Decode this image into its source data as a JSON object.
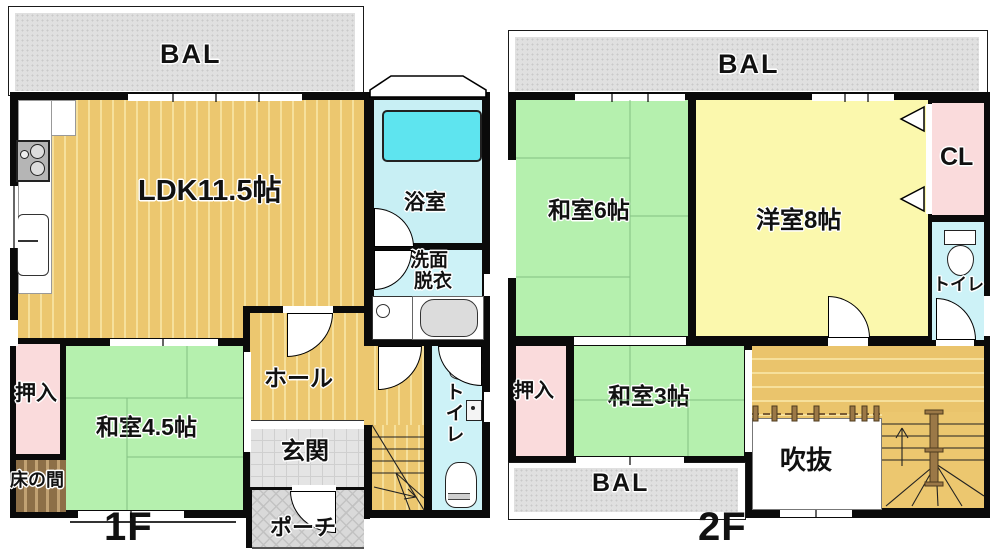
{
  "palette": {
    "wall": "#0a0a0a",
    "wood_floor": "#ecc76f",
    "wood_stripe": "#f6e09c",
    "tatami_green": "#b5f0ae",
    "western_yellow": "#fbf8ad",
    "closet_pink": "#fadbdc",
    "wet_area_cyan": "#cdf2f7",
    "bathtub_cyan": "#5ee4ef",
    "balcony_gray": "#e0e0e0",
    "tokonoma_brown": "#8d6f47"
  },
  "floor1": {
    "floor_label": "1F",
    "balcony_label": "BAL",
    "rooms": {
      "ldk": "LDK11.5帖",
      "bath": "浴室",
      "washroom_line1": "洗面",
      "washroom_line2": "脱衣",
      "toilet": "トイレ",
      "hall": "ホール",
      "entrance": "玄関",
      "porch": "ポーチ",
      "closet": "押入",
      "tatami_room": "和室4.5帖",
      "tokonoma": "床の間"
    }
  },
  "floor2": {
    "floor_label": "2F",
    "balcony_top_label": "BAL",
    "balcony_bottom_label": "BAL",
    "rooms": {
      "tatami6": "和室6帖",
      "western8": "洋室8帖",
      "closet_cl": "CL",
      "toilet": "トイレ",
      "oshiire": "押入",
      "tatami3": "和室3帖",
      "void": "吹抜"
    }
  }
}
